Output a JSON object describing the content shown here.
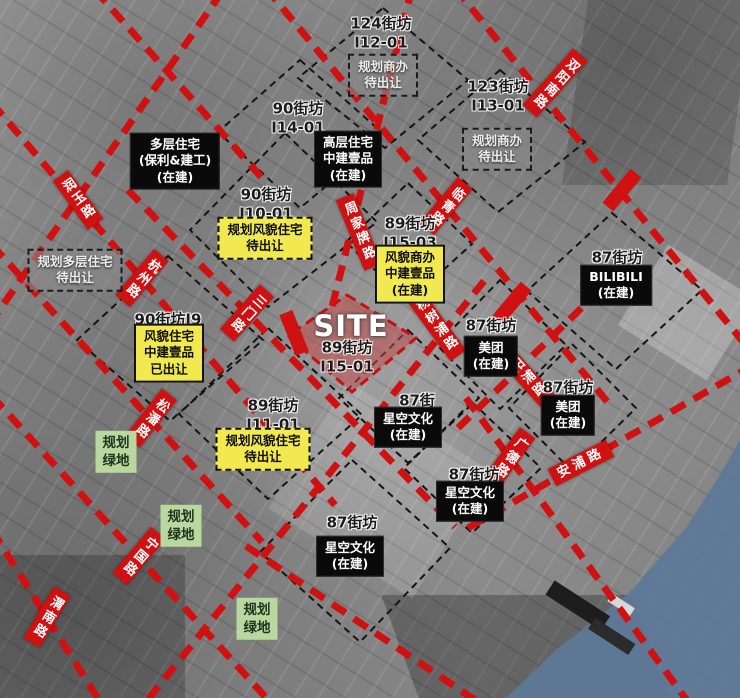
{
  "colors": {
    "road_red": "#cf1111",
    "yellow": "#f1e94f",
    "green": "#b8d8a0",
    "black_box": "#0a0a0a",
    "water_blue": "#5d7898",
    "site_fill": "rgba(192,75,75,0.55)"
  },
  "site": {
    "title": "SITE",
    "block": "89街坊\nI15-01"
  },
  "roads": [
    {
      "id": "runyu-road",
      "text": "润玉路"
    },
    {
      "id": "shuangyang-south-road",
      "text": "双阳南路"
    },
    {
      "id": "hangzhou-road",
      "text": "杭州路"
    },
    {
      "id": "zhoujiapai-road",
      "text": "周家牌路"
    },
    {
      "id": "linqing-road",
      "text": "临青路"
    },
    {
      "id": "sanmen-road",
      "text": "三门路"
    },
    {
      "id": "yangshupu-road",
      "text": "杨树浦路"
    },
    {
      "id": "yangpu-road",
      "text": "阳浦路"
    },
    {
      "id": "guangde-road",
      "text": "广德路"
    },
    {
      "id": "anpu-road",
      "text": "安浦路"
    },
    {
      "id": "songpan-road",
      "text": "松潘路"
    },
    {
      "id": "ningguo-road",
      "text": "宁国路"
    },
    {
      "id": "weinan-road",
      "text": "渭南路"
    }
  ],
  "blocks": [
    {
      "text": "124街坊\nI12-01"
    },
    {
      "text": "123街坊\nI13-01"
    },
    {
      "text": "90街坊\nI14-01"
    },
    {
      "text": "90街坊\nI10-01"
    },
    {
      "text": "89街坊\nI15-03"
    },
    {
      "text": "87街坊"
    },
    {
      "text": "90街坊I9"
    },
    {
      "text": "87街坊"
    },
    {
      "text": "87街坊"
    },
    {
      "text": "89街坊\nI11-01"
    },
    {
      "text": "87街"
    },
    {
      "text": "87街坊"
    },
    {
      "text": "87街坊"
    }
  ],
  "projects": [
    {
      "text": "多层住宅\n(保利&建工)\n(在建)"
    },
    {
      "text": "高层住宅\n中建壹品\n(在建)"
    },
    {
      "text": "BILIBILI\n(在建)"
    },
    {
      "text": "美团\n(在建)"
    },
    {
      "text": "美团\n(在建)"
    },
    {
      "text": "星空文化\n(在建)"
    },
    {
      "text": "星空文化\n(在建)"
    },
    {
      "text": "星空文化\n(在建)"
    }
  ],
  "yellow_solid": [
    {
      "text": "风貌商办\n中建壹品\n(在建)"
    },
    {
      "text": "风貌住宅\n中建壹品\n已出让"
    }
  ],
  "yellow_dashed": [
    {
      "text": "规划风貌住宅\n待出让"
    },
    {
      "text": "规划风貌住宅\n待出让"
    }
  ],
  "gray_dashed": [
    {
      "text": "规划商办\n待出让"
    },
    {
      "text": "规划商办\n待出让"
    },
    {
      "text": "规划多层住宅\n待出让"
    }
  ],
  "greens": [
    {
      "text": "规划\n绿地"
    },
    {
      "text": "规划\n绿地"
    },
    {
      "text": "规划\n绿地"
    }
  ]
}
